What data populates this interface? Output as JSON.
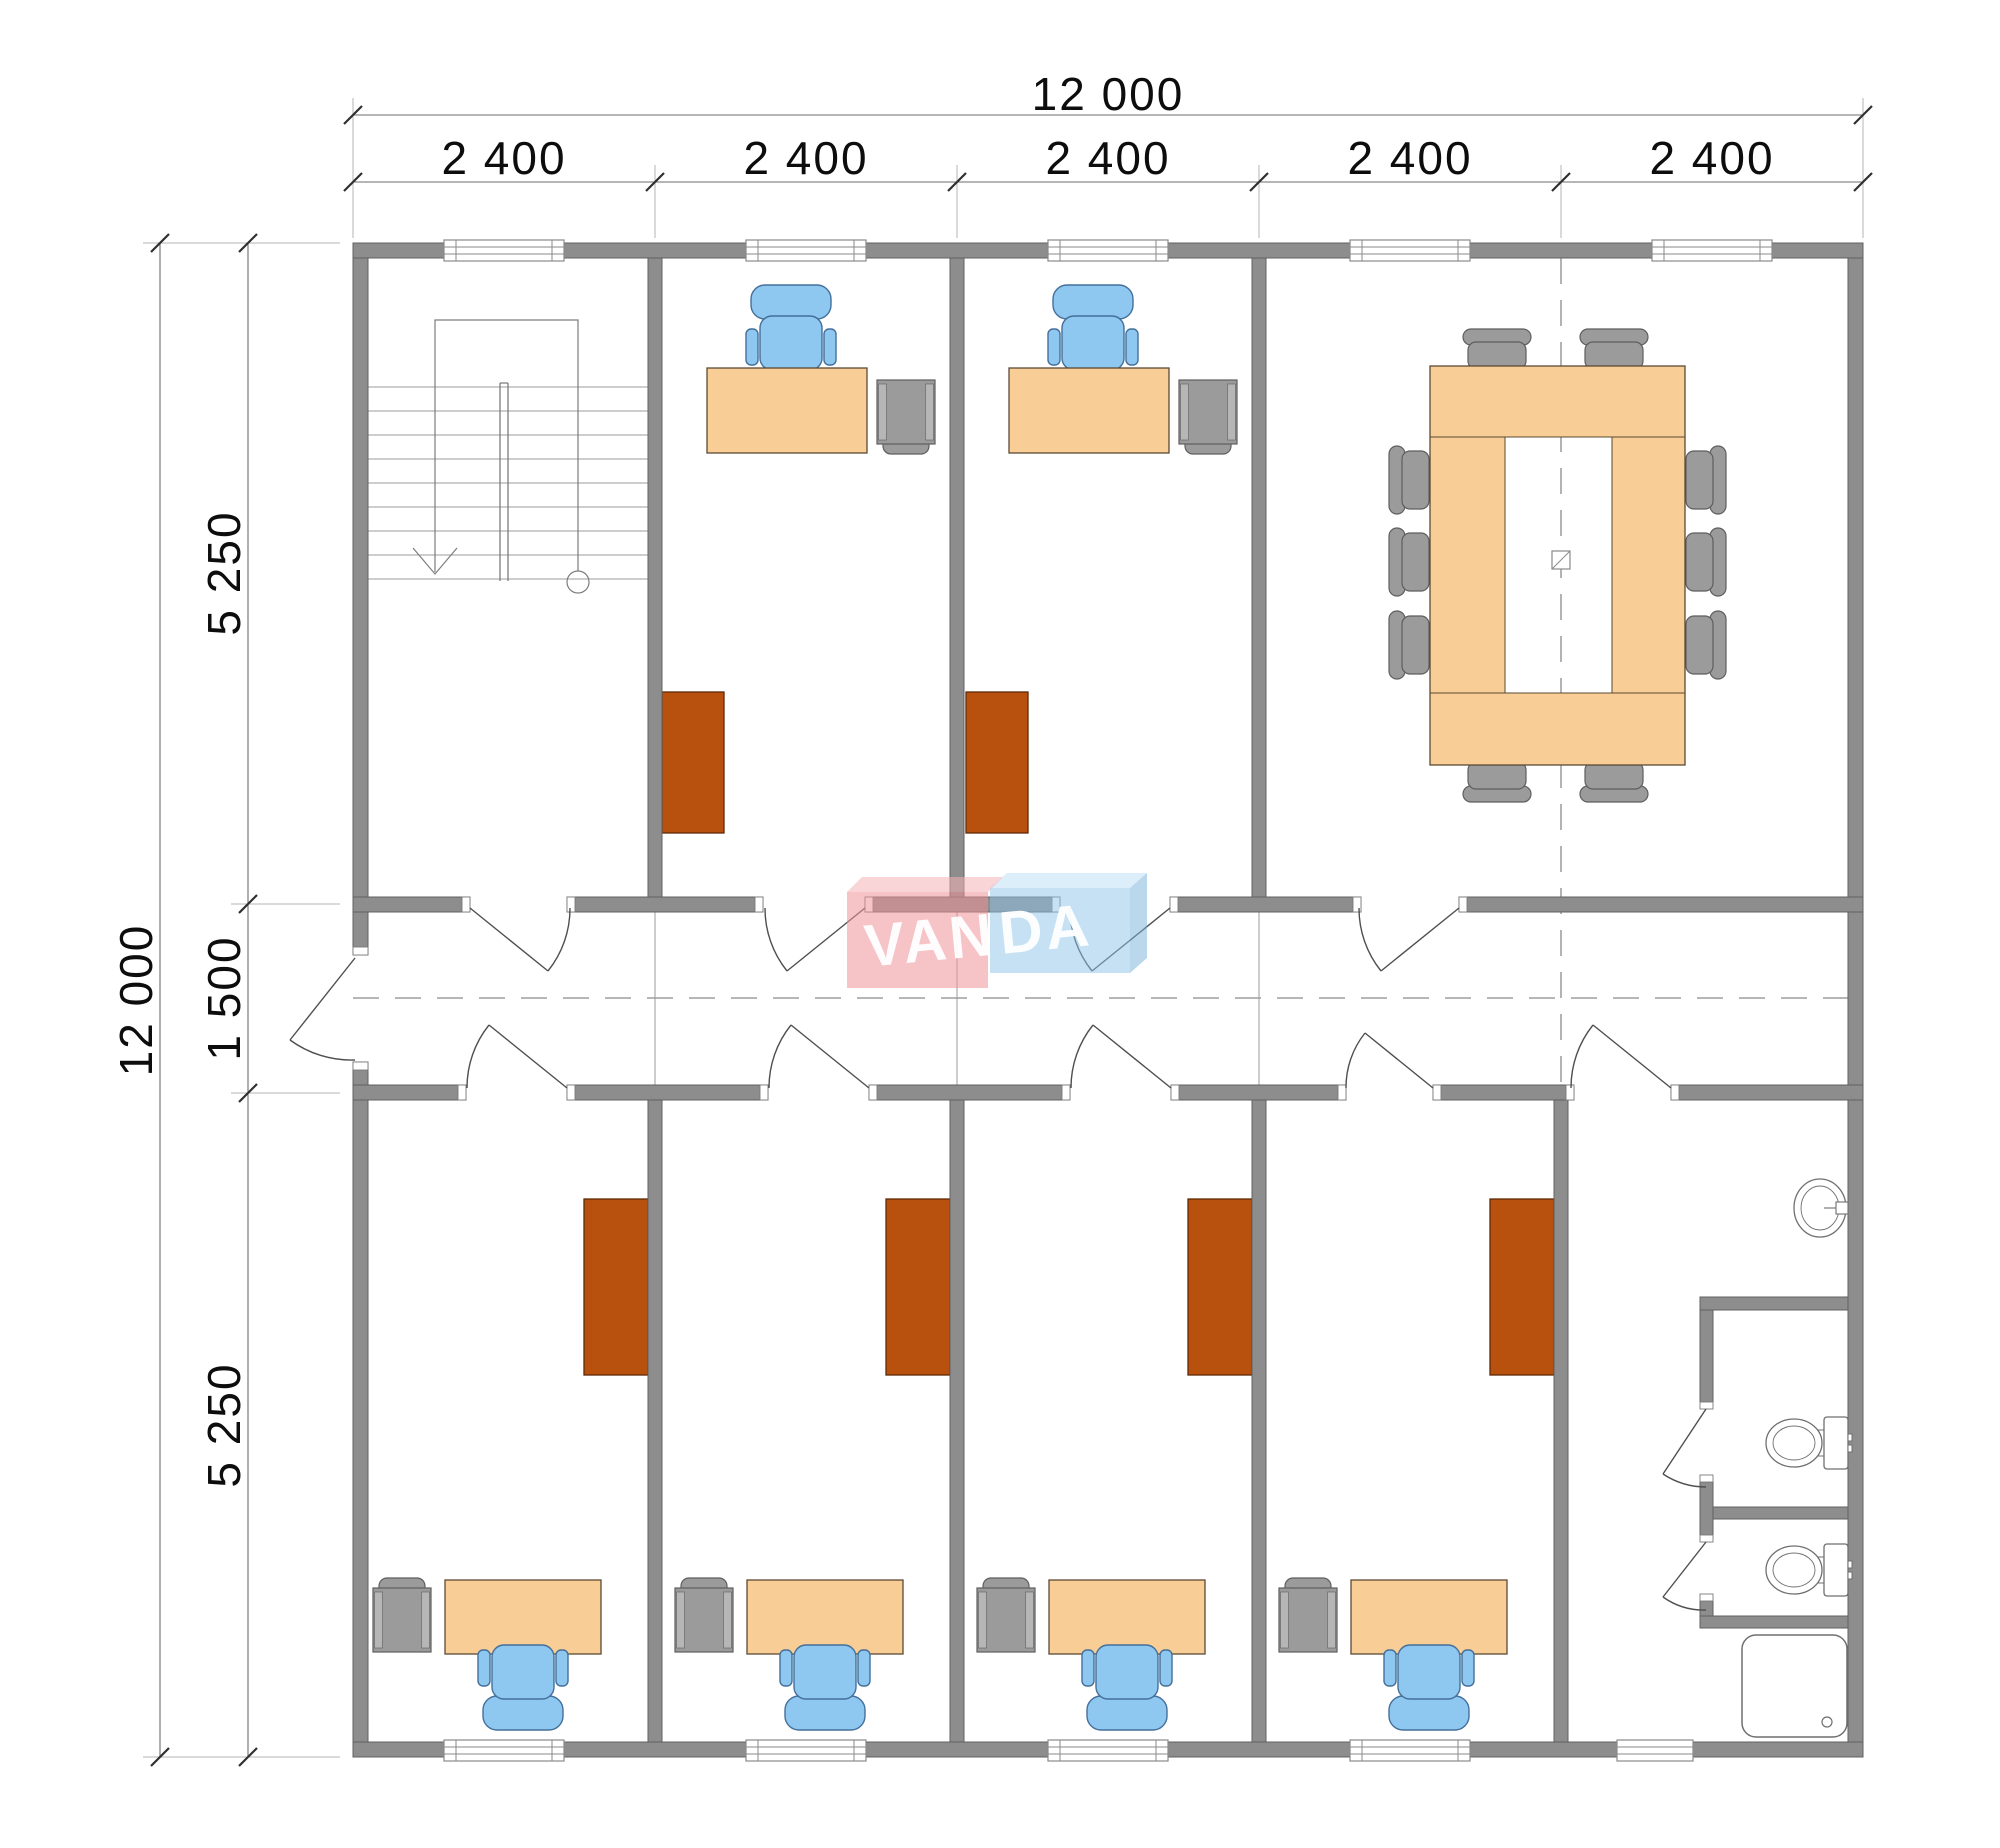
{
  "drawing": {
    "type": "architectural floor plan, 2-row office module building with central corridor",
    "dimensions_top": {
      "total": "12 000",
      "segments": [
        "2 400",
        "2 400",
        "2 400",
        "2 400",
        "2 400"
      ]
    },
    "dimensions_side": {
      "total": "12 000",
      "segments": [
        "5 250",
        "1 500",
        "5 250"
      ]
    },
    "logo": {
      "part1": "VAN",
      "part2": "DA"
    },
    "rooms": [
      "staircase",
      "office",
      "office",
      "conference room",
      "office",
      "office",
      "office",
      "office",
      "wc with 2 toilet stalls, sink and shower"
    ],
    "colors": {
      "wall": "#8d8d8d",
      "wallEdge": "#616161",
      "desk": "#f8cd96",
      "deskEdge": "#5a4a33",
      "chair": "#8ec7f0",
      "chairEdge": "#44709a",
      "cabinet": "#b8500e",
      "cabinetEdge": "#5f2a06",
      "furnGray": "#9b9b9b",
      "furnGrayLight": "#b6b6b6",
      "furnGrayEdge": "#5e5e5e",
      "line": "#6e6e6e",
      "lineLight": "#9b9b9b",
      "ext": "#b5b5b5",
      "fixture": "#6f6f6f",
      "dimText": "#0d0d0d",
      "logoText": "#ffffff"
    }
  }
}
